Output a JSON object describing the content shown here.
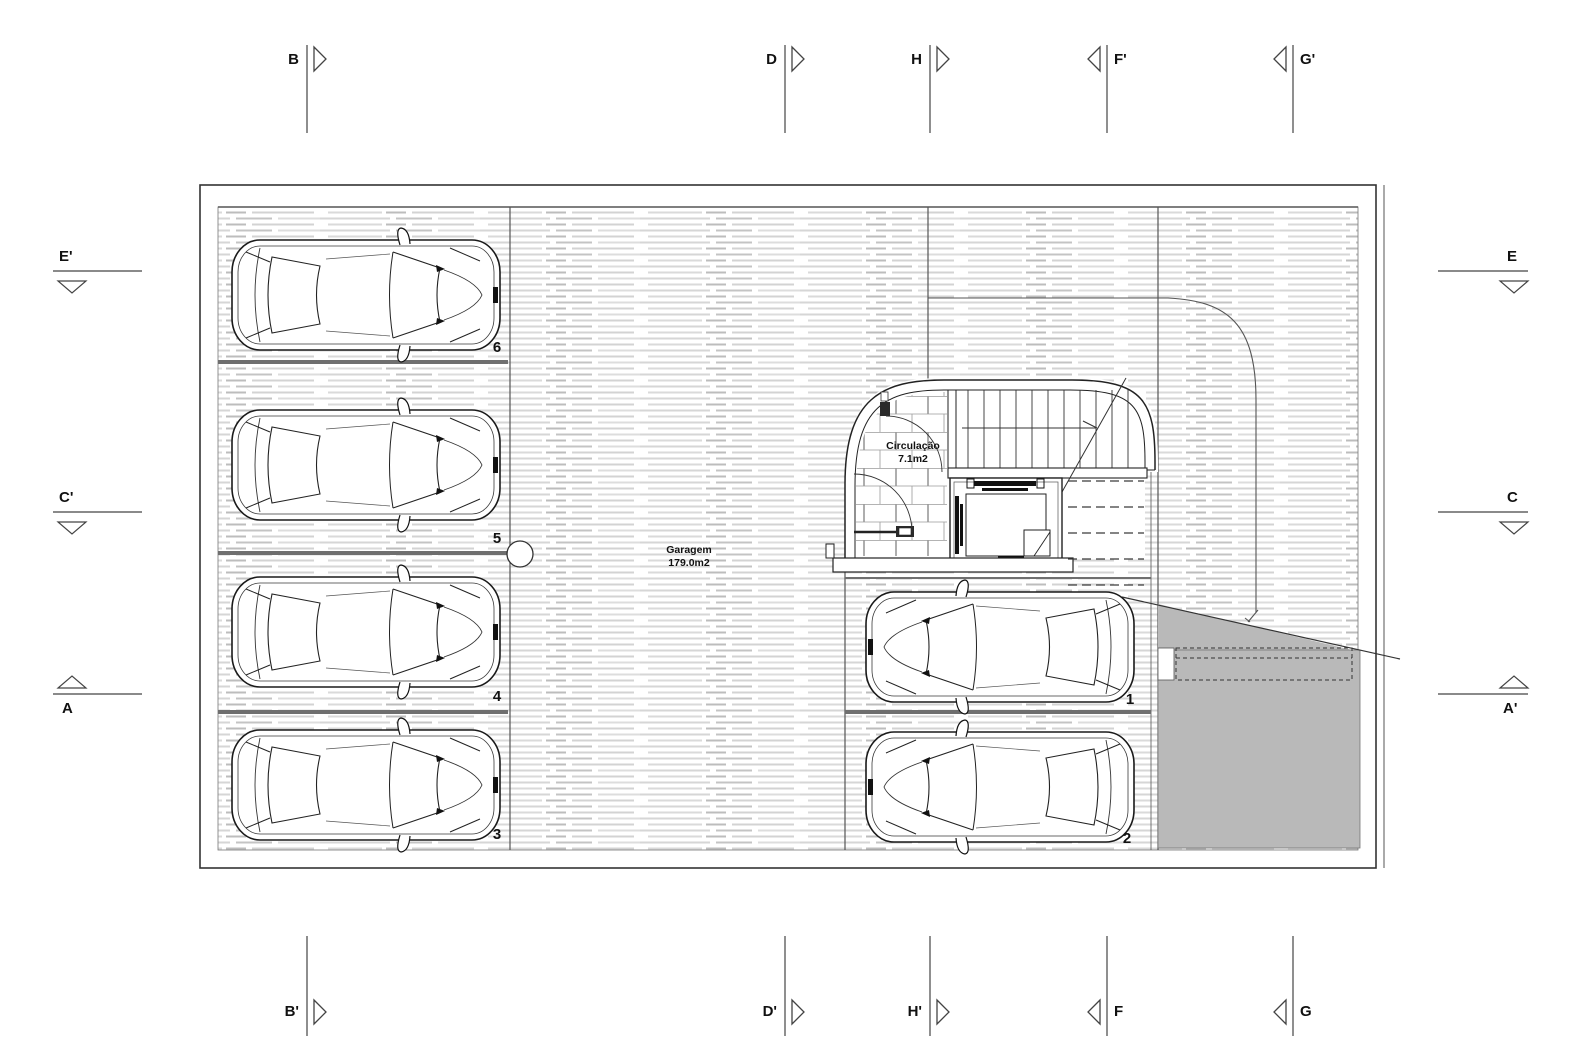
{
  "document": {
    "type": "garage-floor-plan"
  },
  "rooms": {
    "garagem": {
      "name": "Garagem",
      "area": "179.0m2"
    },
    "circulacao": {
      "name": "Circulação",
      "area": "7.1m2"
    }
  },
  "stalls": {
    "s6": "6",
    "s5": "5",
    "s4": "4",
    "s3": "3",
    "s1": "1",
    "s2": "2"
  },
  "section_markers": {
    "top": [
      {
        "label": "B"
      },
      {
        "label": "D"
      },
      {
        "label": "H"
      },
      {
        "label": "F'"
      },
      {
        "label": "G'"
      }
    ],
    "bottom": [
      {
        "label": "B'"
      },
      {
        "label": "D'"
      },
      {
        "label": "H'"
      },
      {
        "label": "F"
      },
      {
        "label": "G"
      }
    ],
    "left": [
      {
        "label": "E'"
      },
      {
        "label": "C'"
      },
      {
        "label": "A"
      }
    ],
    "right": [
      {
        "label": "E"
      },
      {
        "label": "C"
      },
      {
        "label": "A'"
      }
    ]
  },
  "colors": {
    "ramp": "#b9b9b9",
    "line": "#333333",
    "hatch": "#d6d6d6"
  }
}
